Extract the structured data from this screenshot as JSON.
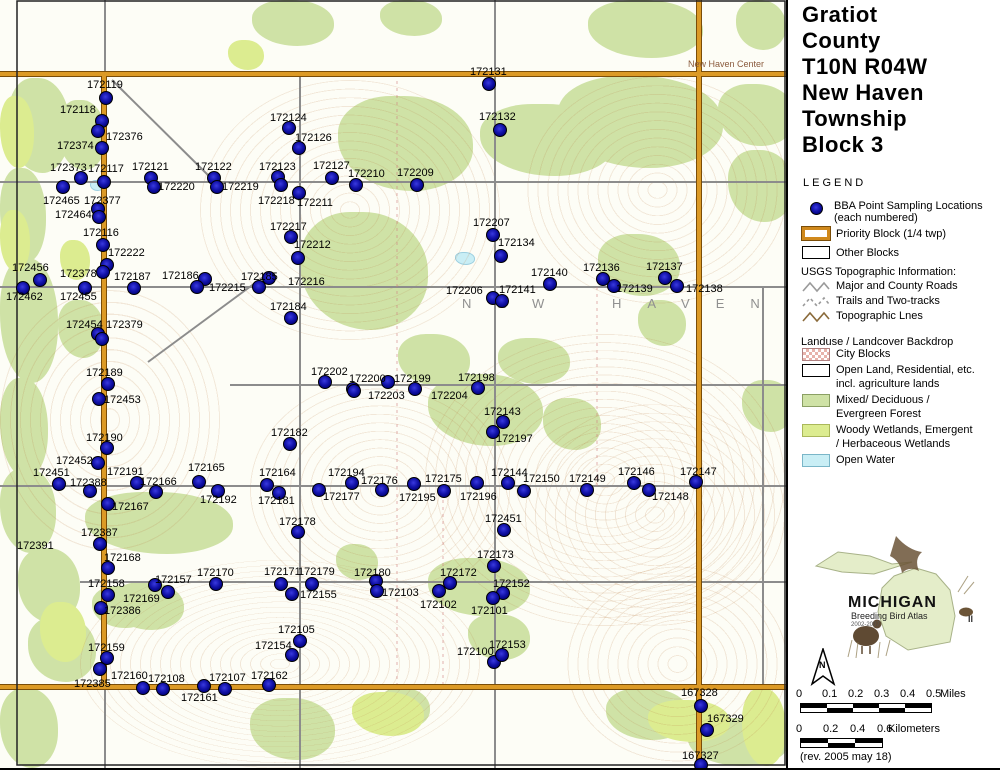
{
  "panel": {
    "title_lines": [
      "Gratiot",
      "County",
      "T10N R04W",
      "New Haven",
      "Township",
      "Block 3"
    ],
    "legend_heading": "LEGEND",
    "legend_point": {
      "line1": "BBA Point Sampling Locations",
      "line2": "(each numbered)"
    },
    "legend_blocks": [
      {
        "swatch": "priority",
        "label": "Priority Block (1/4 twp)"
      },
      {
        "swatch": "other",
        "label": "Other Blocks"
      }
    ],
    "usgs_heading": "USGS Topographic Information:",
    "usgs_items": [
      {
        "swatch": "zigzag-gray",
        "label": "Major and County Roads"
      },
      {
        "swatch": "zigzag-dashed",
        "label": "Trails and Two-tracks"
      },
      {
        "swatch": "zigzag-brown",
        "label": "Topographic Lnes"
      }
    ],
    "landuse_heading": "Landuse / Landcover Backdrop",
    "landuse_items": [
      {
        "swatch": "city",
        "lines": [
          "City Blocks"
        ]
      },
      {
        "swatch": "open",
        "lines": [
          "Open Land, Residential, etc.",
          "incl. agriculture lands"
        ]
      },
      {
        "swatch": "forest",
        "lines": [
          "Mixed/ Deciduous /",
          "Evergreen Forest"
        ]
      },
      {
        "swatch": "wetland",
        "lines": [
          "Woody Wetlands, Emergent",
          "/ Herbaceous Wetlands"
        ]
      },
      {
        "swatch": "water",
        "lines": [
          "Open Water"
        ]
      }
    ],
    "logo": {
      "title": "MICHIGAN",
      "subtitle": "Breeding Bird Atlas",
      "years": "2002-2007",
      "numeral": "II"
    },
    "north_label": "N",
    "scale_miles": {
      "ticks": [
        "0",
        "0.1",
        "0.2",
        "0.3",
        "0.4",
        "0.5"
      ],
      "unit": "Miles"
    },
    "scale_km": {
      "ticks": [
        "0",
        "0.2",
        "0.4",
        "0.6"
      ],
      "unit": "Kilometers"
    },
    "revision": "(rev. 2005 may 18)"
  },
  "map": {
    "area_label": "NEW HAVEN",
    "place_label": "New Haven Center",
    "points": [
      [
        "172119",
        87,
        79,
        105,
        97
      ],
      [
        "172118",
        60,
        104,
        101,
        120
      ],
      [
        "172376",
        106,
        131,
        97,
        130
      ],
      [
        "172374",
        57,
        140,
        101,
        147
      ],
      [
        "172373",
        50,
        162,
        80,
        177
      ],
      [
        "172117",
        88,
        163,
        103,
        181
      ],
      [
        "172465",
        43,
        195,
        62,
        186
      ],
      [
        "172377",
        84,
        195,
        97,
        208
      ],
      [
        "172464",
        55,
        209,
        98,
        216
      ],
      [
        "172116",
        83,
        227,
        102,
        244
      ],
      [
        "172222",
        108,
        247,
        106,
        264
      ],
      [
        "172378",
        60,
        268,
        102,
        271
      ],
      [
        "172456",
        12,
        262,
        39,
        279
      ],
      [
        "172462",
        6,
        291,
        22,
        287
      ],
      [
        "172455",
        60,
        291,
        84,
        287
      ],
      [
        "172454",
        66,
        319,
        97,
        333
      ],
      [
        "172379",
        106,
        319,
        101,
        338
      ],
      [
        "172189",
        86,
        367,
        107,
        383
      ],
      [
        "172453",
        104,
        394,
        98,
        398
      ],
      [
        "172190",
        86,
        432,
        106,
        447
      ],
      [
        "172452",
        56,
        455,
        97,
        462
      ],
      [
        "172451",
        33,
        467,
        58,
        483
      ],
      [
        "172388",
        70,
        477,
        89,
        490
      ],
      [
        "172191",
        107,
        466,
        136,
        482
      ],
      [
        "172166",
        140,
        476,
        155,
        491
      ],
      [
        "172165",
        188,
        462,
        198,
        481
      ],
      [
        "172192",
        200,
        494,
        217,
        490
      ],
      [
        "172167",
        112,
        501,
        107,
        503
      ],
      [
        "172391",
        17,
        540,
        -1,
        -1
      ],
      [
        "172387",
        81,
        527,
        99,
        543
      ],
      [
        "172168",
        104,
        552,
        107,
        567
      ],
      [
        "172158",
        88,
        578,
        107,
        594
      ],
      [
        "172157",
        155,
        574,
        154,
        584
      ],
      [
        "172169",
        123,
        593,
        167,
        591
      ],
      [
        "172170",
        197,
        567,
        215,
        583
      ],
      [
        "172386",
        104,
        605,
        100,
        607
      ],
      [
        "172159",
        88,
        642,
        106,
        657
      ],
      [
        "172385",
        74,
        678,
        99,
        668
      ],
      [
        "172160",
        111,
        670,
        142,
        687
      ],
      [
        "172108",
        148,
        673,
        162,
        688
      ],
      [
        "172161",
        181,
        692,
        203,
        685
      ],
      [
        "172107",
        209,
        672,
        224,
        688
      ],
      [
        "172162",
        251,
        670,
        268,
        684
      ],
      [
        "172124",
        270,
        112,
        288,
        127
      ],
      [
        "172126",
        295,
        132,
        298,
        147
      ],
      [
        "172123",
        259,
        161,
        277,
        176
      ],
      [
        "172121",
        132,
        161,
        150,
        177
      ],
      [
        "172220",
        158,
        181,
        153,
        186
      ],
      [
        "172122",
        195,
        161,
        213,
        177
      ],
      [
        "172219",
        222,
        181,
        216,
        186
      ],
      [
        "172218",
        258,
        195,
        280,
        184
      ],
      [
        "172211",
        297,
        197,
        298,
        192
      ],
      [
        "172127",
        313,
        160,
        331,
        177
      ],
      [
        "172210",
        348,
        168,
        355,
        184
      ],
      [
        "172209",
        397,
        167,
        416,
        184
      ],
      [
        "172131",
        470,
        66,
        488,
        83
      ],
      [
        "172132",
        479,
        111,
        499,
        129
      ],
      [
        "172217",
        270,
        221,
        290,
        236
      ],
      [
        "172212",
        294,
        239,
        297,
        257
      ],
      [
        "172207",
        473,
        217,
        492,
        234
      ],
      [
        "172134",
        498,
        237,
        500,
        255
      ],
      [
        "172187",
        114,
        271,
        133,
        287
      ],
      [
        "172186",
        162,
        270,
        204,
        278
      ],
      [
        "172215",
        209,
        282,
        196,
        286
      ],
      [
        "172185",
        241,
        271,
        258,
        286
      ],
      [
        "172216",
        288,
        276,
        268,
        277
      ],
      [
        "172206",
        446,
        285,
        492,
        297
      ],
      [
        "172141",
        499,
        284,
        501,
        300
      ],
      [
        "172140",
        531,
        267,
        549,
        283
      ],
      [
        "172136",
        583,
        262,
        602,
        278
      ],
      [
        "172139",
        616,
        283,
        613,
        285
      ],
      [
        "172137",
        646,
        261,
        664,
        277
      ],
      [
        "172138",
        686,
        283,
        676,
        285
      ],
      [
        "172184",
        270,
        301,
        290,
        317
      ],
      [
        "172202",
        311,
        366,
        324,
        381
      ],
      [
        "172200",
        349,
        373,
        352,
        388
      ],
      [
        "172199",
        394,
        373,
        387,
        381
      ],
      [
        "172203",
        368,
        390,
        353,
        390
      ],
      [
        "172204",
        431,
        390,
        414,
        388
      ],
      [
        "172198",
        458,
        372,
        477,
        387
      ],
      [
        "172143",
        484,
        406,
        502,
        421
      ],
      [
        "172197",
        496,
        433,
        492,
        431
      ],
      [
        "172182",
        271,
        427,
        289,
        443
      ],
      [
        "172164",
        259,
        467,
        266,
        484
      ],
      [
        "172181",
        258,
        495,
        278,
        492
      ],
      [
        "172194",
        328,
        467,
        351,
        482
      ],
      [
        "172176",
        361,
        475,
        381,
        489
      ],
      [
        "172177",
        323,
        491,
        318,
        489
      ],
      [
        "172175",
        425,
        473,
        413,
        483
      ],
      [
        "172195",
        399,
        492,
        443,
        490
      ],
      [
        "172196",
        460,
        491,
        476,
        482
      ],
      [
        "172144",
        491,
        467,
        507,
        482
      ],
      [
        "172150",
        523,
        473,
        523,
        490
      ],
      [
        "172149",
        569,
        473,
        586,
        489
      ],
      [
        "172146",
        618,
        466,
        633,
        482
      ],
      [
        "172148",
        652,
        491,
        648,
        489
      ],
      [
        "172147",
        680,
        466,
        695,
        481
      ],
      [
        "172451",
        485,
        513,
        503,
        529
      ],
      [
        "172178",
        279,
        516,
        297,
        531
      ],
      [
        "172173",
        477,
        549,
        493,
        565
      ],
      [
        "172171",
        264,
        566,
        280,
        583
      ],
      [
        "172179",
        298,
        566,
        311,
        583
      ],
      [
        "172155",
        300,
        589,
        291,
        593
      ],
      [
        "172180",
        354,
        567,
        375,
        580
      ],
      [
        "172103",
        382,
        587,
        376,
        590
      ],
      [
        "172172",
        440,
        567,
        449,
        582
      ],
      [
        "172102",
        420,
        599,
        438,
        590
      ],
      [
        "172152",
        493,
        578,
        502,
        592
      ],
      [
        "172101",
        471,
        605,
        492,
        597
      ],
      [
        "172105",
        278,
        624,
        299,
        640
      ],
      [
        "172154",
        255,
        640,
        291,
        654
      ],
      [
        "172100",
        457,
        646,
        493,
        661
      ],
      [
        "172153",
        489,
        639,
        501,
        654
      ],
      [
        "167328",
        681,
        687,
        700,
        705
      ],
      [
        "167329",
        707,
        713,
        706,
        729
      ],
      [
        "167327",
        682,
        750,
        700,
        764
      ]
    ]
  }
}
